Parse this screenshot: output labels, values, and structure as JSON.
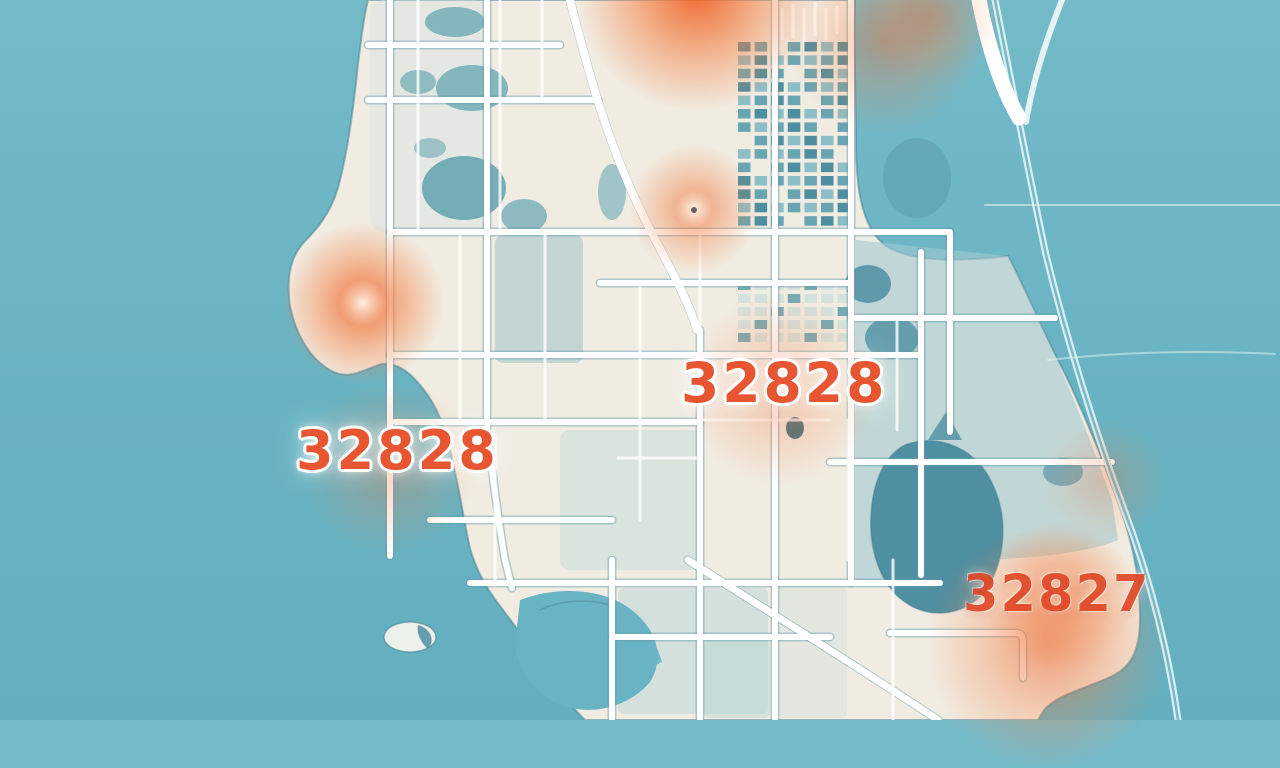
{
  "map": {
    "description": "Stylized zip-code heat map of a coastal city",
    "zip_labels": [
      {
        "text": "32828",
        "position": "center",
        "x": 681,
        "y": 356,
        "size": 55,
        "style": "strong"
      },
      {
        "text": "32828",
        "position": "west",
        "x": 296,
        "y": 424,
        "size": 54,
        "style": "strong"
      },
      {
        "text": "32827",
        "position": "southeast",
        "x": 963,
        "y": 569,
        "size": 51,
        "style": "soft"
      }
    ],
    "heat_spots": [
      {
        "x": 697,
        "y": -8,
        "r": 118,
        "intensity": 0.95,
        "core": false
      },
      {
        "x": 884,
        "y": 40,
        "r": 95,
        "intensity": 0.4,
        "core": false
      },
      {
        "x": 930,
        "y": 15,
        "r": 70,
        "intensity": 0.35,
        "core": false
      },
      {
        "x": 363,
        "y": 303,
        "r": 80,
        "intensity": 0.85,
        "core": true
      },
      {
        "x": 694,
        "y": 209,
        "r": 64,
        "intensity": 0.6,
        "core": true
      },
      {
        "x": 780,
        "y": 390,
        "r": 95,
        "intensity": 0.35,
        "core": false
      },
      {
        "x": 390,
        "y": 468,
        "r": 88,
        "intensity": 0.3,
        "core": false
      },
      {
        "x": 1060,
        "y": 596,
        "r": 75,
        "intensity": 0.5,
        "core": false
      },
      {
        "x": 1047,
        "y": 648,
        "r": 120,
        "intensity": 0.55,
        "core": false
      },
      {
        "x": 1105,
        "y": 480,
        "r": 62,
        "intensity": 0.25,
        "core": false
      }
    ],
    "colors": {
      "water": "#69b4c4",
      "land": "#f1ece2",
      "road": "#ffffff",
      "road_casing": "#5f9aa8",
      "park": "#6aa9b4",
      "lake": "#4f8fa2",
      "downtown_block": "#4d8ea0",
      "heat": "#ef6428",
      "label_strong": "#e75531",
      "label_soft": "#e04a28"
    }
  }
}
